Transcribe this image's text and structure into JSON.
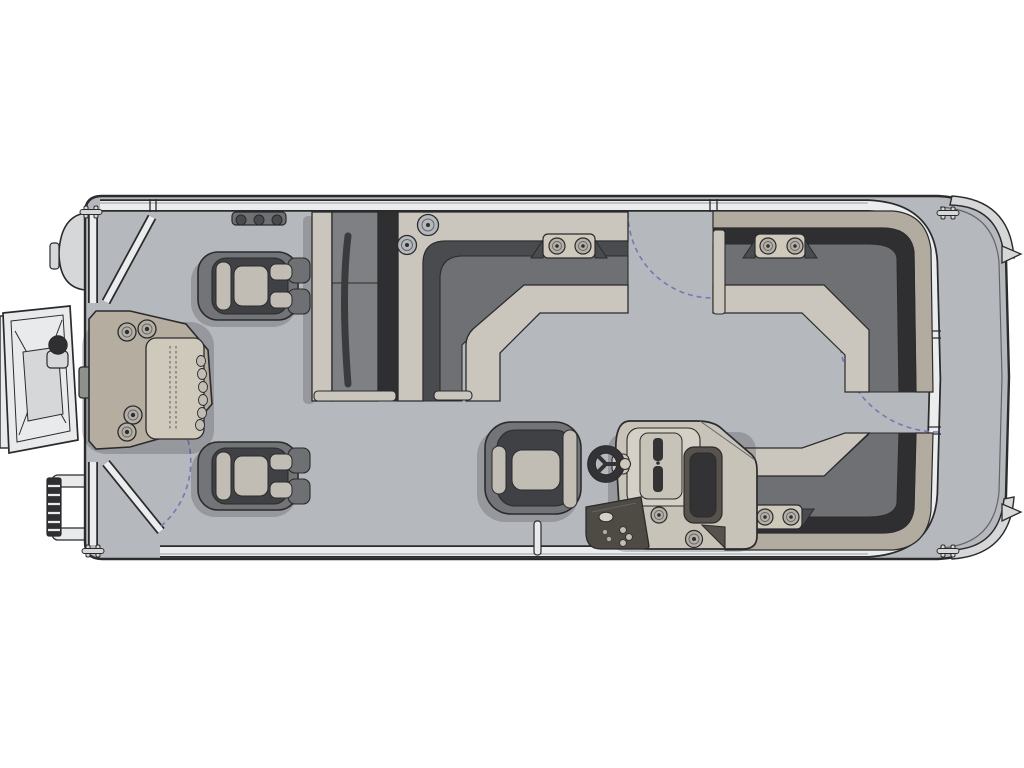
{
  "meta": {
    "type": "boat-floor-plan",
    "subject": "Pontoon boat deck layout, overhead view, bow at left and stern at right",
    "text_visible": "none"
  },
  "palette": {
    "background": "#ffffff",
    "line": "#2b2b2c",
    "deck": "#b5b8bc",
    "fence_white": "#ebecee",
    "cushion_light": "#cac6bd",
    "seat_gray": "#6f7073",
    "seat_mid": "#7e8083",
    "seat_shadow": "#2f2f31",
    "backrest_face": "#4a4b4f",
    "trim_tan": "#b2ab9f",
    "chair_outer": "#737477",
    "chair_inner": "#404145",
    "chair_cushion": "#c1bdb4",
    "console_body": "#c8c3b8",
    "console_panel": "#d5d0c5",
    "console_dark": "#57534c",
    "pod_dark": "#4e4a44",
    "wheel_dark": "#333336",
    "station_body": "#b4ada0",
    "station_table": "#cfc9bc",
    "hardware_white": "#e9eaec",
    "metal_gray": "#d6d7d9",
    "dark_knob": "#2f2f31",
    "pad_gray": "#8e908c",
    "ring_fill": "#b5b0a6",
    "swing_arc": "#7678b6"
  },
  "components": {
    "hull": "pontoon deck with rounded stern platform, rub rail, two stern fins, corner caps",
    "gates": [
      "bow port gate with dashed swing arc",
      "port midship gate with dashed swing arc",
      "starboard stern gate with dashed swing arc"
    ],
    "furniture": [
      "bow fishing station with 4 cup holders, textured table, pad row and latch plate",
      "two bow pedestal fishing chairs",
      "back-to-back center bench with L-shaped wraparound lounge",
      "port stern L-lounge with twin cup-holder pod",
      "starboard stern L-lounge with twin cup-holder pod",
      "helm console with steering wheel, gauge stack, switch pod and two cup holders",
      "captain helm chair",
      "two round table-base plates",
      "three-knob accessory rail",
      "ski tow post"
    ],
    "exterior": [
      "bow boarding ramp with cross bracing and tow knob",
      "folding re-boarding ladder with two mounting arms",
      "four mooring cleats",
      "port bow fender"
    ]
  }
}
